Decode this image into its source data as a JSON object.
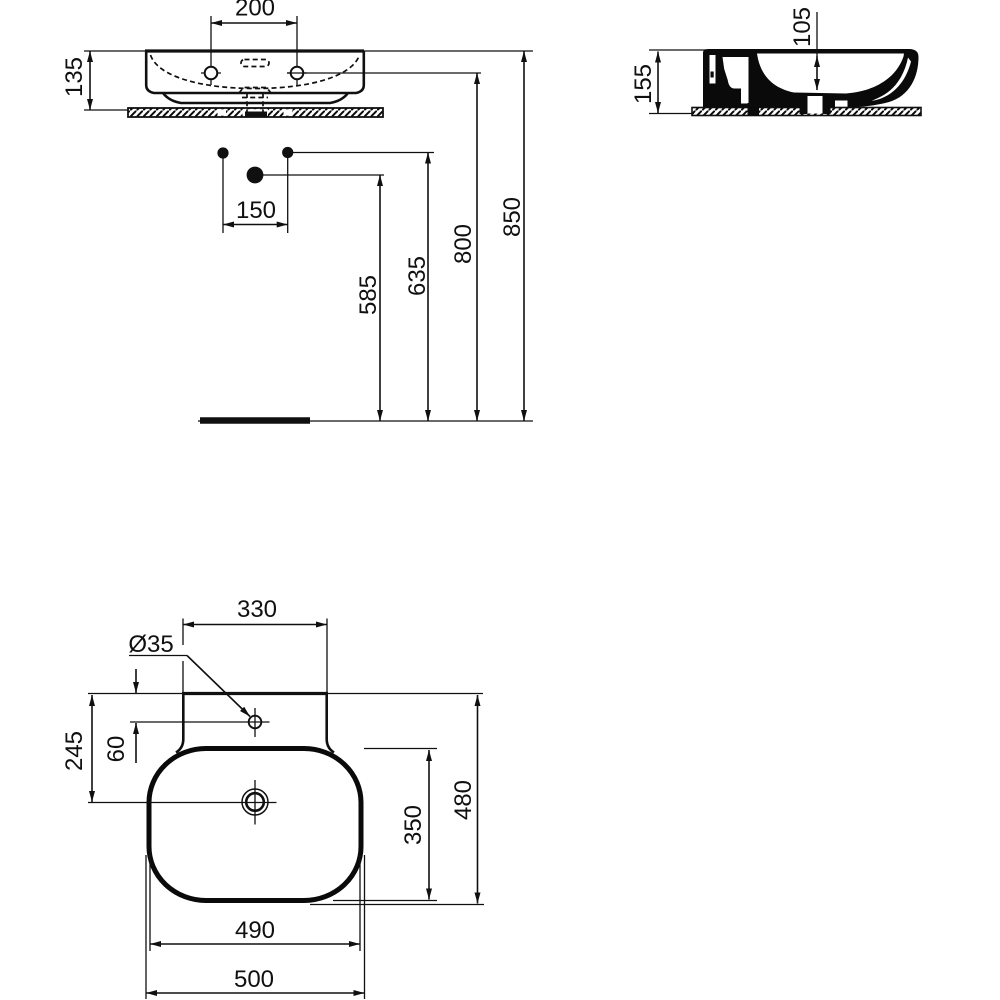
{
  "background_color": "#ffffff",
  "line_color": "#101010",
  "front_view": {
    "taphole_spacing": "200",
    "basin_height": "135",
    "fixing_hole_spacing": "150",
    "drain_outlet_height": "585",
    "fixing_hole_height": "635",
    "taphole_height": "800",
    "rim_height": "850"
  },
  "side_view": {
    "overall_height": "155",
    "bowl_inner_depth": "105"
  },
  "plan_view": {
    "back_ledge_width": "330",
    "taphole_diameter": "Ø35",
    "drain_setback": "245",
    "taphole_setback": "60",
    "bowl_front_back": "350",
    "overall_depth": "480",
    "bowl_width": "490",
    "overall_width": "500"
  }
}
